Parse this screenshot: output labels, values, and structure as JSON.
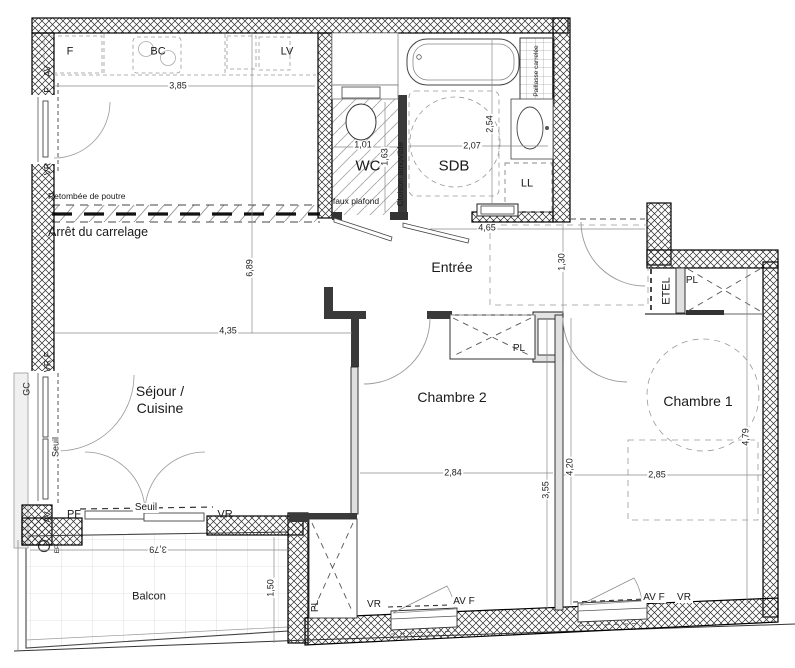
{
  "colors": {
    "ink": "#1a1a1a",
    "wall_hatch": "#2b2b2b"
  },
  "rooms": {
    "sejour_line1": "Séjour /",
    "sejour_line2": "Cuisine",
    "chambre1": "Chambre 1",
    "chambre2": "Chambre 2",
    "entree": "Entrée",
    "wc": "WC",
    "sdb": "SDB",
    "balcon": "Balcon"
  },
  "appliances": {
    "f": "F",
    "bc": "BC",
    "lv": "LV",
    "ll": "LL"
  },
  "storage": {
    "pl": "PL",
    "etel": "ETEL"
  },
  "openings": {
    "av": "AV",
    "f": "F",
    "vr": "VR",
    "vr_f": "VR F",
    "av_f": "AV F",
    "pf": "PF",
    "seuil": "Seuil",
    "gc": "GC",
    "ep": "EP"
  },
  "notes": {
    "retombee": "Retombée de poutre",
    "arret": "Arrêt du carrelage",
    "faux_plafond": "faux plafond",
    "cloison": "Cloison amovible",
    "paillasse": "Paillasse carrelée"
  },
  "dims": {
    "sejour_width_top": "3,85",
    "sejour_height": "6,89",
    "sejour_width": "4,35",
    "wc_width": "1,01",
    "wc_depth": "1,63",
    "sdb_width": "2,07",
    "sdb_depth": "2,54",
    "entree_width": "4,65",
    "hall_depth": "1,30",
    "chambre2_width": "2,84",
    "chambre2_depth": "3,55",
    "chambre1_left_depth": "4,20",
    "chambre1_width": "2,85",
    "chambre1_depth": "4,79",
    "balcon_width": "3,79",
    "balcon_depth": "1,50"
  }
}
